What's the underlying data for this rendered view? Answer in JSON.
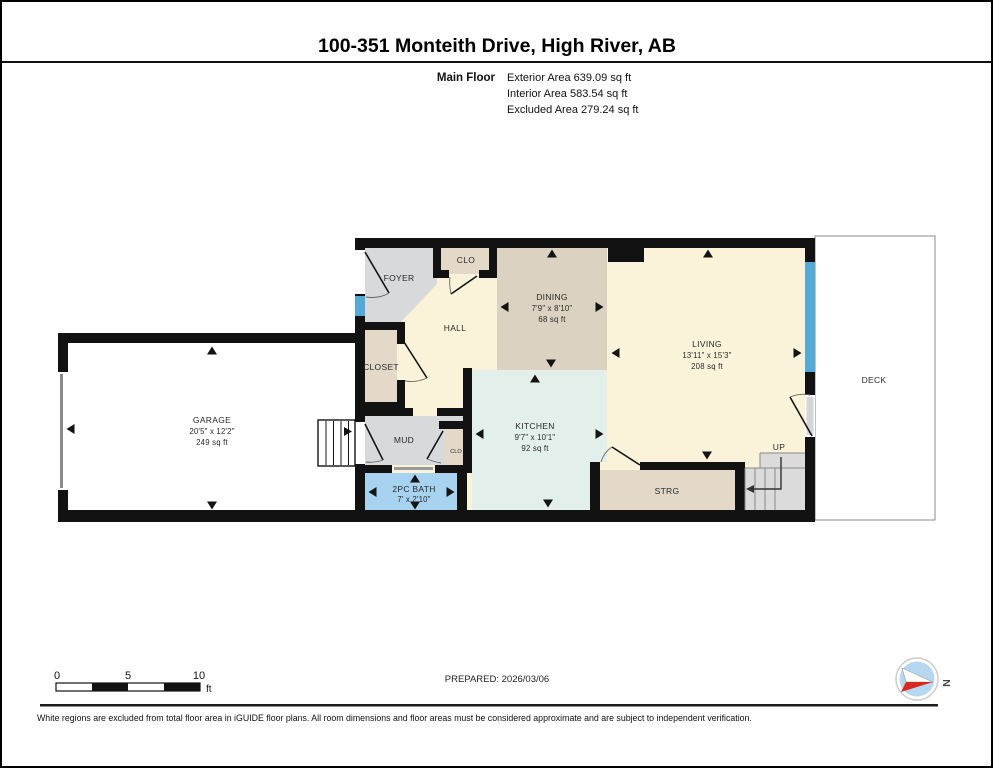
{
  "header": {
    "title": "100-351 Monteith Drive, High River, AB",
    "floor_label": "Main Floor",
    "areas": [
      "Exterior Area 639.09 sq ft",
      "Interior Area 583.54 sq ft",
      "Excluded Area 279.24 sq ft"
    ]
  },
  "rooms": {
    "garage": {
      "name": "GARAGE",
      "dims": "20'5\" x 12'2\"",
      "area": "249 sq ft"
    },
    "foyer": {
      "name": "FOYER"
    },
    "foyer_closet": {
      "name": "CLO"
    },
    "hall": {
      "name": "HALL"
    },
    "closet": {
      "name": "CLOSET"
    },
    "dining": {
      "name": "DINING",
      "dims": "7'9\" x 8'10\"",
      "area": "68 sq ft"
    },
    "living": {
      "name": "LIVING",
      "dims": "13'11\" x 15'3\"",
      "area": "208 sq ft"
    },
    "kitchen": {
      "name": "KITCHEN",
      "dims": "9'7\" x 10'1\"",
      "area": "92 sq ft"
    },
    "mud": {
      "name": "MUD"
    },
    "mud_closet": {
      "name": "CLO"
    },
    "bath": {
      "name": "2PC BATH",
      "dims": "7' x 2'10\""
    },
    "storage": {
      "name": "STRG"
    },
    "stairs": {
      "name": "UP"
    },
    "deck": {
      "name": "DECK"
    }
  },
  "scale_bar": {
    "ticks": [
      "0",
      "5",
      "10"
    ],
    "unit": "ft"
  },
  "prepared_label": "PREPARED: 2026/03/06",
  "compass": {
    "north_label": "N"
  },
  "footer_note": "White regions are excluded from total floor area in iGUIDE floor plans. All room dimensions and floor areas must be considered approximate and are subject to independent verification.",
  "colors": {
    "wall": "#121212",
    "room_cream": "#FAF3DA",
    "room_tan": "#DBD2C1",
    "room_mint": "#E2EFEA",
    "room_gray": "#D8D9DA",
    "room_beige": "#E4D9C8",
    "room_blue": "#A7D2F0",
    "stairs_gray": "#DBDBDC",
    "window_blue": "#55A9D6",
    "excluded_white": "#FFFFFF",
    "compass_blue": "#B5D8F0",
    "compass_red": "#D8281E"
  }
}
